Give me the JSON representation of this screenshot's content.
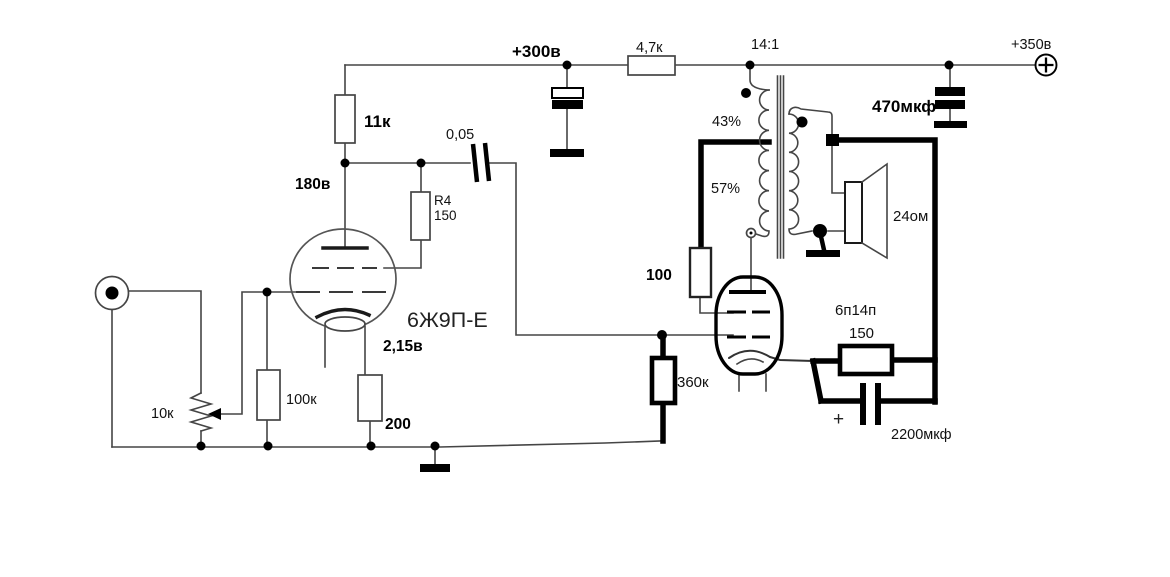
{
  "colors": {
    "ink": "#000000",
    "wire": "#454545",
    "background": "#ffffff"
  },
  "labels": {
    "b300": "+300в",
    "r_drop": "4,7к",
    "ratio": "14:1",
    "b350": "+350в",
    "r_anode": "11к",
    "c_couple": "0,05",
    "c_filter2": "470мкф",
    "v_anode": "180в",
    "r_screen_name": "R4",
    "r_screen_val": "150",
    "tap_upper": "43%",
    "tap_lower": "57%",
    "spk": "24ом",
    "r_g2stop": "100",
    "tube_out": "6п14п",
    "r_cath_out": "150",
    "tube_in": "6Ж9П-Е",
    "v_cath": "2,15в",
    "r_grid_out": "360к",
    "c_cath_out": "2200мкф",
    "plus_cap": "+",
    "r_pot": "10к",
    "r_grid_in": "100к",
    "r_cath_in": "200"
  }
}
